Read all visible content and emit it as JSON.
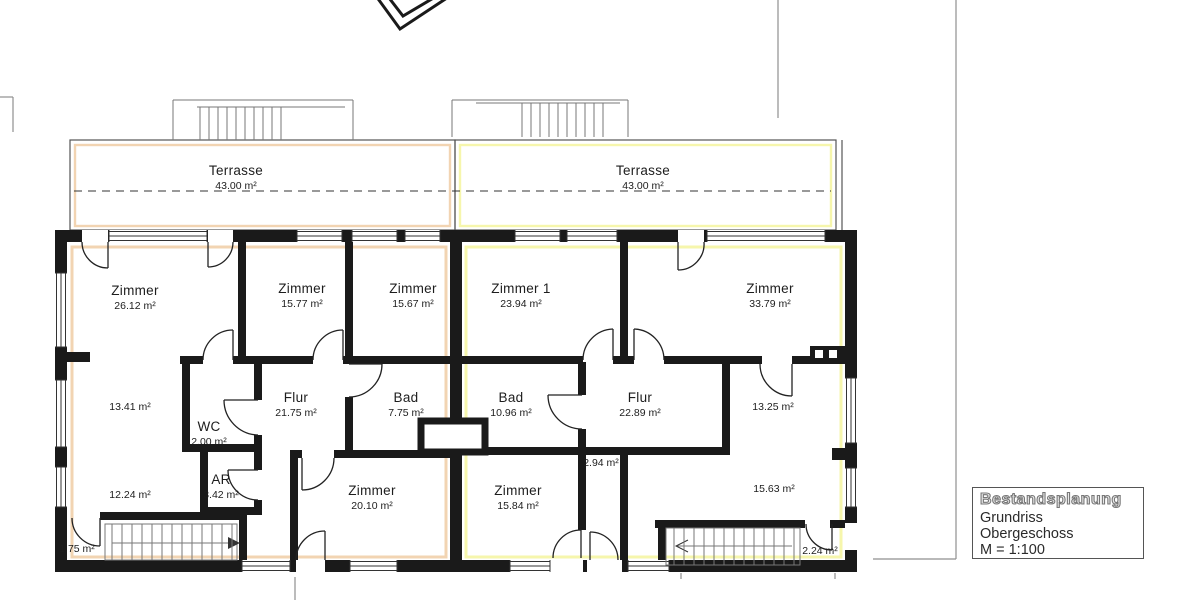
{
  "plan": {
    "terraces": {
      "left": {
        "name": "Terrasse",
        "area": "43.00 m²"
      },
      "right": {
        "name": "Terrasse",
        "area": "43.00 m²"
      }
    },
    "rooms": {
      "zimmer_26": {
        "name": "Zimmer",
        "area": "26.12 m²"
      },
      "zimmer_1577": {
        "name": "Zimmer",
        "area": "15.77 m²"
      },
      "zimmer_1567": {
        "name": "Zimmer",
        "area": "15.67 m²"
      },
      "flur_left": {
        "name": "Flur",
        "area": "21.75 m²"
      },
      "bad_left": {
        "name": "Bad",
        "area": "7.75 m²"
      },
      "wc": {
        "name": "WC",
        "area": "2.00 m²"
      },
      "ar": {
        "name": "AR",
        "area": "3.42 m²"
      },
      "zimmer_2010": {
        "name": "Zimmer",
        "area": "20.10 m²"
      },
      "zimmer_1": {
        "name": "Zimmer 1",
        "area": "23.94 m²"
      },
      "zimmer_3379": {
        "name": "Zimmer",
        "area": "33.79 m²"
      },
      "bad_right": {
        "name": "Bad",
        "area": "10.96 m²"
      },
      "flur_right": {
        "name": "Flur",
        "area": "22.89 m²"
      },
      "zimmer_1584": {
        "name": "Zimmer",
        "area": "15.84 m²"
      }
    },
    "dimensions": {
      "left_upper": "13.41 m²",
      "left_lower": "12.24 m²",
      "left_landing": "1.75 m²",
      "right_upper": "13.25 m²",
      "right_shaft": "2.94 m²",
      "right_lower": "15.63 m²",
      "right_landing": "2.24 m²"
    },
    "title_block": {
      "title": "Bestandsplanung",
      "subtitle": "Grundriss Obergeschoss",
      "scale": "M = 1:100"
    },
    "colors": {
      "unit_left_highlight": "#f2d4b2",
      "unit_right_highlight": "#f6f6ac",
      "wall": "#1a1a1a",
      "boundary_line": "#8f8f8f"
    }
  }
}
